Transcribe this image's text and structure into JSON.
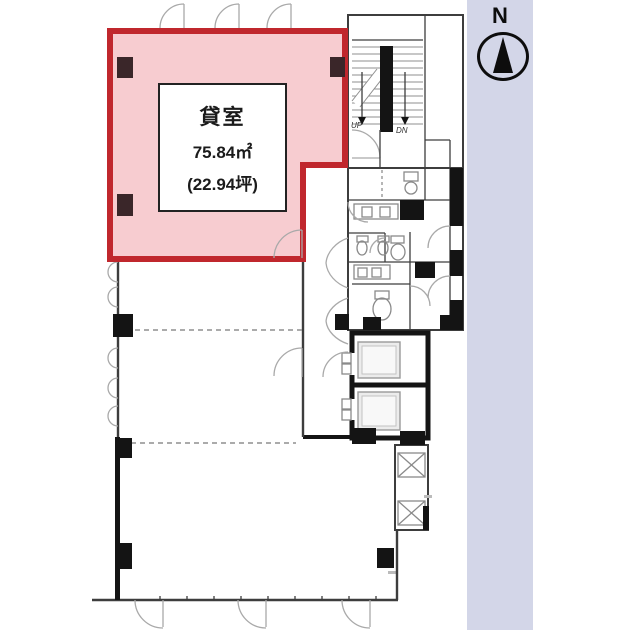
{
  "colors": {
    "room-fill": "#f7ccd0",
    "room-border": "#c0272d",
    "wall": "#3d3d3d",
    "wall-light": "#8f8f8f",
    "fixture": "#8a8a8a",
    "door": "#a9a9a9",
    "black": "#141414",
    "column-pink": "#3a2629",
    "sidebar": "#d3d6e8",
    "text": "#1b1b1b"
  },
  "room_label": {
    "name": "貸室",
    "area_sqm": "75.84㎡",
    "area_tsubo": "(22.94坪)"
  },
  "stairs": {
    "up": "UP",
    "dn": "DN"
  },
  "compass": {
    "north": "N"
  }
}
